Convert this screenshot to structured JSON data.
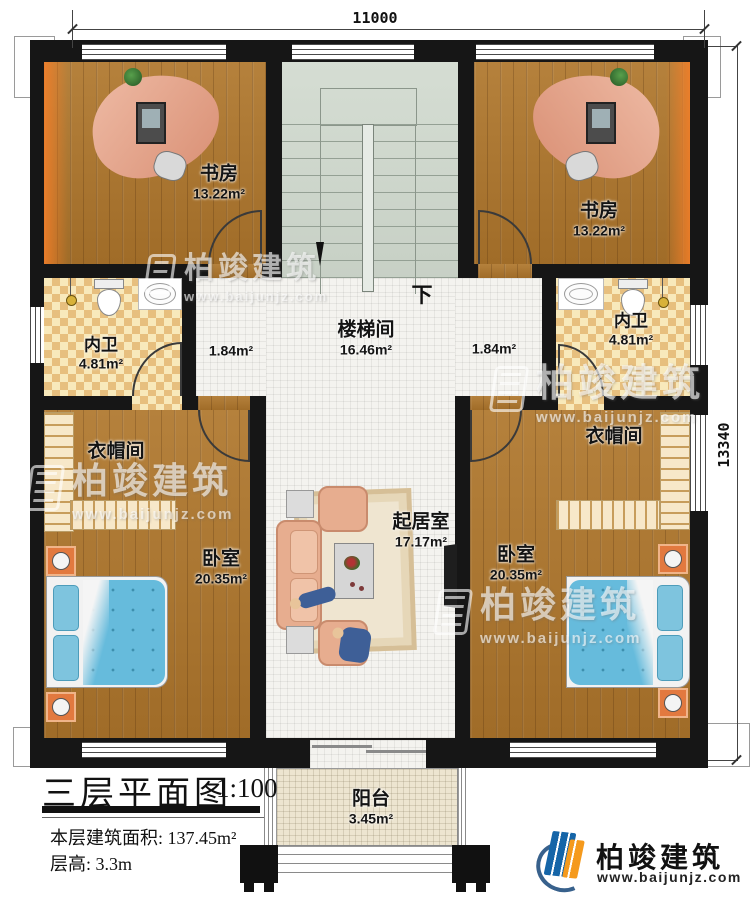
{
  "dims": {
    "width_mm": "11000",
    "height_mm": "13340"
  },
  "rooms": {
    "study_left": {
      "name": "书房",
      "area": "13.22m²"
    },
    "study_right": {
      "name": "书房",
      "area": "13.22m²"
    },
    "stairwell": {
      "name": "楼梯间",
      "area": "16.46m²",
      "down": "下"
    },
    "bath_left": {
      "name": "内卫",
      "area": "4.81m²"
    },
    "bath_right": {
      "name": "内卫",
      "area": "4.81m²"
    },
    "corridor_left": {
      "area": "1.84m²"
    },
    "corridor_right": {
      "area": "1.84m²"
    },
    "closet_left": {
      "name": "衣帽间"
    },
    "closet_right": {
      "name": "衣帽间"
    },
    "bedroom_left": {
      "name": "卧室",
      "area": "20.35m²"
    },
    "bedroom_right": {
      "name": "卧室",
      "area": "20.35m²"
    },
    "living": {
      "name": "起居室",
      "area": "17.17m²"
    },
    "balcony": {
      "name": "阳台",
      "area": "3.45m²"
    }
  },
  "title_block": {
    "plan_title": "三层平面图",
    "scale": "1:100",
    "floor_area_label": "本层建筑面积:",
    "floor_area_value": "137.45m²",
    "floor_height_label": "层高:",
    "floor_height_value": "3.3m"
  },
  "brand": {
    "name": "柏竣建筑",
    "website": "www.baijunjz.com"
  },
  "watermark": {
    "name": "柏竣建筑",
    "website": "www.baijunjz.com"
  },
  "colors": {
    "wall": "#161616",
    "wood": "#ab7832",
    "tile": "#f4f3ef",
    "checker": "#f3dfac",
    "stair": "#cfd7cc",
    "balcony": "#ede5d0",
    "bed": "#66bbdc",
    "sofa": "#e7ad8f",
    "brand_blue": "#1565a8",
    "brand_orange": "#f59a1d"
  }
}
